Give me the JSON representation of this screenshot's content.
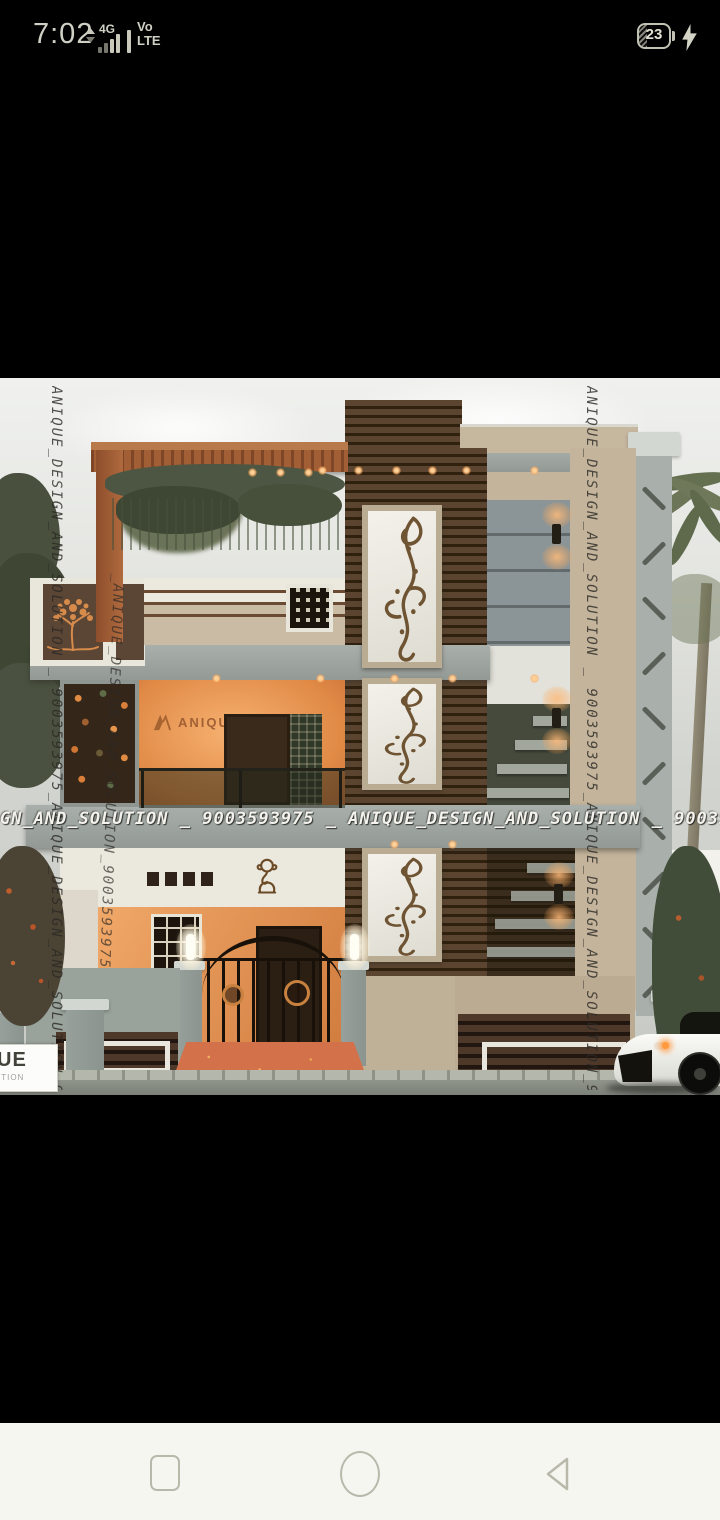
{
  "status_bar": {
    "time": "7:02",
    "network": "4G",
    "volte_top": "Vo",
    "volte_bottom": "LTE",
    "battery_percent": "23",
    "icons": [
      "data-arrows-icon",
      "signal-bars-icon",
      "battery-icon",
      "charging-bolt-icon"
    ]
  },
  "photo": {
    "description": "3D front elevation render of a modern two-storey house at dusk with wood cladding, floral wall panels, iron gate, compound wall and a white sports car",
    "watermark_left": "ANIQUE_DESIGN_AND_SOLUTION _ 9003593975_ANIQUE_DESIGN_AND_SOLUTION_9003593975",
    "watermark_left2": "_ANIQUE_DESIGN_AND_SOLUTION_9003593975",
    "watermark_right": "ANIQUE_DESIGN_AND_SOLUTION _ 9003593975_ANIQUE_DESIGN_AND_SOLUTION_900359397",
    "watermark_band": "GN_AND_SOLUTION _ 9003593975 _ ANIQUE_DESIGN_AND_SOLUTION _ 9003593975 _ ANIQUE_DESIGN_AND_SOLUTION _",
    "balcony_brand": "ANIQUE",
    "corner_brand_top": "UE",
    "corner_brand_bottom": "LUTION"
  },
  "nav_bar": {
    "buttons": [
      {
        "name": "recents",
        "icon": "square-icon"
      },
      {
        "name": "home",
        "icon": "circle-icon"
      },
      {
        "name": "back",
        "icon": "triangle-icon"
      }
    ]
  },
  "colors": {
    "screen_background": "#000000",
    "status_text": "#d0d0c4",
    "photo_sky": "#e6e7e3",
    "wood_brown": "#4e3a27",
    "wall_beige": "#c3b49b",
    "slab_grey": "#9ba19d",
    "glow_orange": "#eb9a58",
    "ramp_orange": "#d4764a",
    "nav_background": "#f6f6f1",
    "nav_icon": "#b9b9ab"
  }
}
